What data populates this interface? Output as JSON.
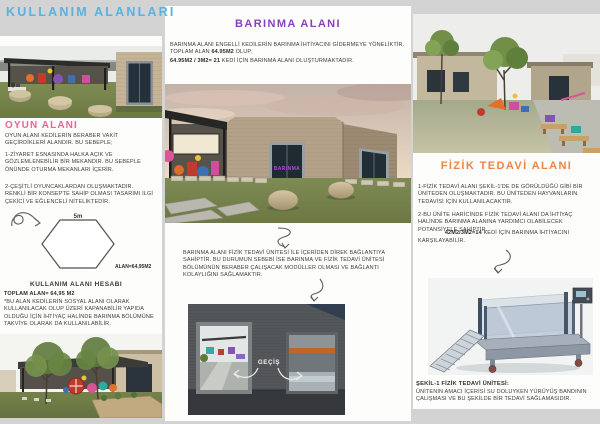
{
  "page": {
    "title": "KULLANIM ALANLARI"
  },
  "colors": {
    "title": "#5bb0e2",
    "oyun_heading": "#ee6395",
    "barinma_heading": "#8a3fc2",
    "fizik_heading": "#ef8340"
  },
  "oyun": {
    "heading": "OYUN ALANI",
    "intro": "OYUN ALANI KEDİLERİN BERABER VAKİT GEÇİRDİKLERİ ALANDIR. BU SEBEPLE;",
    "item1": "1-ZİYARET ESNASINDA HALKA AÇIK VE GÖZLEMLENEBİLİR BİR MEKANDIR. BU SEBEPLE ÖNÜNDE OTURMA MEKANLARI İÇERİR.",
    "item2": "2-ÇEŞİTLİ OYUNCAKLARDAN OLUŞMAKTADIR. RENKLİ BİR KONSEPTE SAHİP OLMASI TASARIMI İLGİ ÇEKİCİ VE EĞLENCELİ NİTELİKTEDİR."
  },
  "hexagon": {
    "side_label": "5m",
    "area_label": "ALAN=64,95M2"
  },
  "hesap": {
    "heading": "KULLANIM ALANI HESABI",
    "total": "TOPLAM ALAN= 64,95 M2",
    "body": "*BU ALAN KEDİLERİN SOSYAL ALANI OLARAK KULLANILACAK OLUP ÜZERİ KAPANABİLİR YAPIDA OLDUĞU İÇİN İHTİYAÇ HALİNDE BARINMA BÖLÜMÜNE TAKVİYE OLARAK DA KULLANILABİLİR."
  },
  "barinma": {
    "heading": "BARINMA ALANI",
    "body_lead": "BARINMA ALANI ENGELLİ KEDİLERİN BARINMA İHTİYACINI GİDERMEYE YÖNELİKTİR. TOPLAM ALAN ",
    "body_bold1": "64.95M2",
    "body_tail1": " OLUP;",
    "body_bold2": "64.95M2 / 3M2= 21",
    "body_tail2": " KEDİ İÇİN BARINMA ALANI OLUŞTURMAKTADIR.",
    "door_sign": "BARINMA"
  },
  "mid_note": "BARINMA ALANI FİZİK TEDAVİ ÜNİTESİ İLE İÇERİDEN DİREK BAĞLANTIYA SAHİPTİR. BU DURUMUN SEBEBİ İSE BARINMA VE FİZİK TEDAVİ ÜNİTESİ BÖLÜMÜNÜN BERABER ÇALIŞACAK MODÜLLER OLMASI VE BAĞLANTI KOLAYLIĞINI SAĞLAMAKTIR.",
  "fizik": {
    "heading": "FİZİK TEDAVİ ALANI",
    "item1": "1-FİZİK TEDAVİ ALANI ŞEKİL-1'DE DE GÖRÜLDÜĞÜ GİBİ BİR ÜNİTEDEN OLUŞMAKTADIR. BU ÜNİTEDEN HAYVANLARIN TEDAVİSİ İÇİN KULLANILACAKTIR.",
    "item2": "2-BU ÜNİTE HARİCİNDE FİZİK TEDAVİ ALANI DA İHTİYAÇ HALİNDE BARINMA ALANINA YARDIMCI OLABİLECEK POTANSİYELE SAHİPTİR.",
    "formula_bold": "42M2/3M2=14",
    "formula_tail": " KEDİ İÇİN BARINMA İHTİYACINI",
    "formula_line2": "KARŞILAYABİLİR."
  },
  "sekil": {
    "heading": "ŞEKİL-1 FİZİK TEDAVİ ÜNİTESİ:",
    "body": "ÜNİTENİN AMACI İÇERİSİ SU DOLUYKEN YÜRÜYÜŞ BANDININ ÇALIŞMASI VE BU ŞEKİLDE BİR TEDAVİ SAĞLAMASIDIR."
  },
  "labels": {
    "gecis": "GEÇİŞ"
  }
}
